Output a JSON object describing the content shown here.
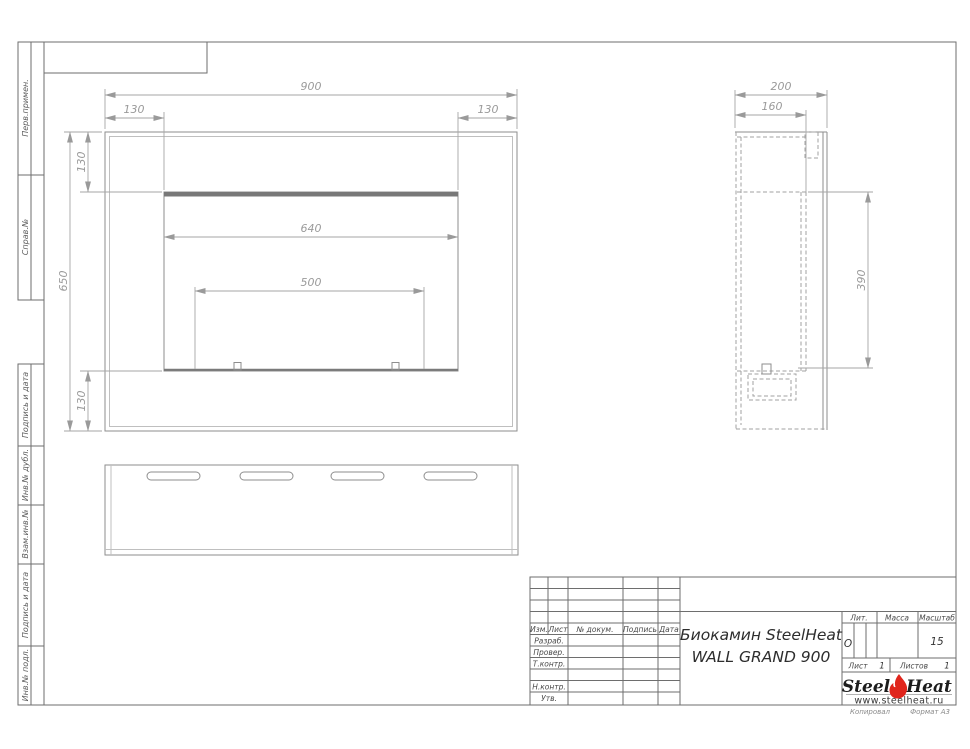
{
  "sheet": {
    "stamps_left": [
      "Перв.примен.",
      "Справ.№",
      "Подпись и дата",
      "Инв.№ дубл.",
      "Взам.инв.№",
      "Подпись и дата",
      "Инв.№ подл."
    ],
    "footer": {
      "copy": "Копировал",
      "format": "Формат А3"
    }
  },
  "views": {
    "front": {
      "width": "900",
      "inset_left": "130",
      "inset_right": "130",
      "height": "650",
      "top_margin": "130",
      "bottom_margin": "130",
      "opening_width": "640",
      "burner_width": "500"
    },
    "side": {
      "depth": "200",
      "inner_depth": "160",
      "opening_height": "390"
    }
  },
  "title_block": {
    "product_line1": "Биокамин SteelHeat",
    "product_line2": "WALL GRAND 900",
    "header_cols": [
      "Изм.",
      "Лист",
      "№ докум.",
      "Подпись",
      "Дата"
    ],
    "row_labels": [
      "Разраб.",
      "Провер.",
      "Т.контр.",
      "Н.контр.",
      "Утв."
    ],
    "lit_label": "Лит.",
    "mass_label": "Масса",
    "scale_label": "Масштаб",
    "lit_value": "О",
    "scale_value": "15",
    "sheet_label": "Лист",
    "sheet_value": "1",
    "sheets_label": "Листов",
    "sheets_value": "1",
    "logo": {
      "steel": "Steel",
      "heat": "Heat",
      "url": "www.steelheat.ru",
      "flame_color": "#e0251c"
    }
  }
}
